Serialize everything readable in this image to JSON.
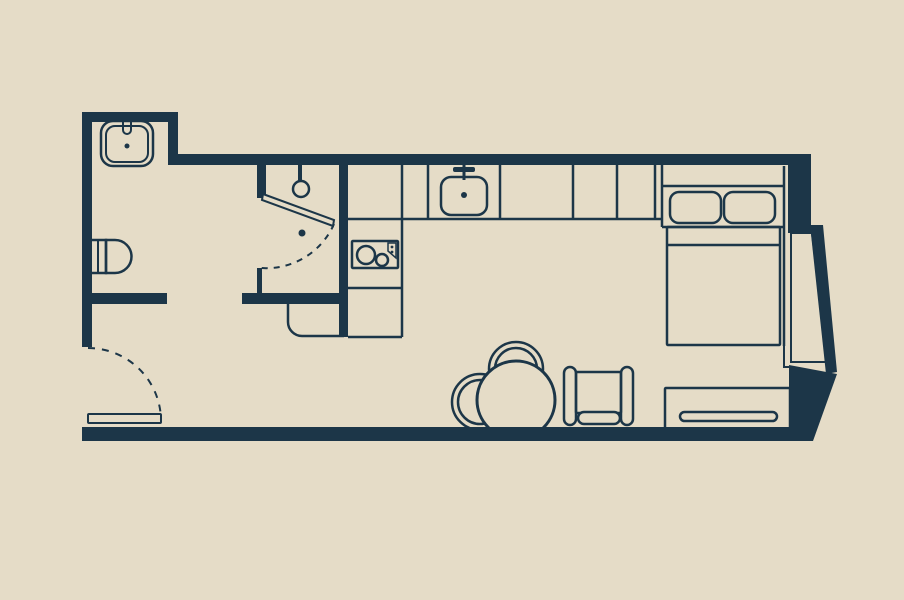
{
  "palette": {
    "background": "#e5dcc7",
    "ink": "#1c3648"
  },
  "canvas": {
    "width": 904,
    "height": 600
  },
  "floorplan": {
    "description_names": {
      "rooms": [
        "bathroom",
        "shower-room",
        "kitchen",
        "living-sleeping-area",
        "entry-hall"
      ],
      "fixtures": [
        "bathroom-sink",
        "toilet",
        "shower-head",
        "shower-door",
        "kitchen-sink",
        "cooktop",
        "kitchen-counter",
        "bed",
        "pillows",
        "window-bay",
        "dining-table",
        "dining-chairs",
        "armchair",
        "dresser",
        "entry-door"
      ]
    },
    "shapes": [
      {
        "name": "bathroom-sink-outer",
        "kind": "rect",
        "x": 101,
        "y": 121,
        "w": 52,
        "h": 45,
        "rx": 12,
        "stroke": "ink",
        "sw": 2.5,
        "fill": "none"
      },
      {
        "name": "bathroom-sink-inner",
        "kind": "rect",
        "x": 106,
        "y": 126,
        "w": 42,
        "h": 36,
        "rx": 9,
        "stroke": "ink",
        "sw": 2,
        "fill": "none"
      },
      {
        "name": "bathroom-sink-faucet",
        "kind": "path",
        "d": "M123,118 V130 A4,4 0 0 0 131,130 V118",
        "stroke": "ink",
        "sw": 2,
        "fill": "none"
      },
      {
        "name": "bathroom-sink-drain",
        "kind": "circle",
        "cx": 127,
        "cy": 146,
        "r": 2.5,
        "fill": "ink",
        "stroke": "none",
        "sw": 0
      },
      {
        "name": "toilet-tank",
        "kind": "rect",
        "x": 90,
        "y": 240,
        "w": 16,
        "h": 33,
        "rx": 0,
        "stroke": "ink",
        "sw": 2.5,
        "fill": "none"
      },
      {
        "name": "toilet-tank-line",
        "kind": "line",
        "x1": 98,
        "y1": 240,
        "x2": 98,
        "y2": 273,
        "stroke": "ink",
        "sw": 2,
        "fill": "none"
      },
      {
        "name": "toilet-bowl",
        "kind": "path",
        "d": "M106,240 H115 A16.5,16.5 0 0 1 115,273 H106 Z",
        "stroke": "ink",
        "sw": 2.5,
        "fill": "none"
      },
      {
        "name": "shower-head-stem",
        "kind": "line",
        "x1": 300,
        "y1": 165,
        "x2": 300,
        "y2": 181,
        "stroke": "ink",
        "sw": 4,
        "fill": "none"
      },
      {
        "name": "shower-head",
        "kind": "circle",
        "cx": 301,
        "cy": 189,
        "r": 8,
        "stroke": "ink",
        "sw": 2.5,
        "fill": "none"
      },
      {
        "name": "kitchen-counter-bottom-line",
        "kind": "line",
        "x1": 348,
        "y1": 219,
        "x2": 662,
        "y2": 219,
        "stroke": "ink",
        "sw": 2.5,
        "fill": "none"
      },
      {
        "name": "kitchen-counter-corner-line",
        "kind": "line",
        "x1": 402,
        "y1": 164,
        "x2": 402,
        "y2": 337,
        "stroke": "ink",
        "sw": 2.5,
        "fill": "none"
      },
      {
        "name": "kitchen-counter-column-bottom",
        "kind": "line",
        "x1": 348,
        "y1": 337,
        "x2": 402,
        "y2": 337,
        "stroke": "ink",
        "sw": 2.5,
        "fill": "none"
      },
      {
        "name": "kitchen-counter-column-divider",
        "kind": "line",
        "x1": 348,
        "y1": 288,
        "x2": 402,
        "y2": 288,
        "stroke": "ink",
        "sw": 2.5,
        "fill": "none"
      },
      {
        "name": "counter-divider-1",
        "kind": "line",
        "x1": 428,
        "y1": 164,
        "x2": 428,
        "y2": 219,
        "stroke": "ink",
        "sw": 2.5,
        "fill": "none"
      },
      {
        "name": "counter-divider-2",
        "kind": "line",
        "x1": 500,
        "y1": 164,
        "x2": 500,
        "y2": 219,
        "stroke": "ink",
        "sw": 2.5,
        "fill": "none"
      },
      {
        "name": "counter-divider-3",
        "kind": "line",
        "x1": 573,
        "y1": 164,
        "x2": 573,
        "y2": 219,
        "stroke": "ink",
        "sw": 2.5,
        "fill": "none"
      },
      {
        "name": "counter-divider-4",
        "kind": "line",
        "x1": 617,
        "y1": 164,
        "x2": 617,
        "y2": 219,
        "stroke": "ink",
        "sw": 2.5,
        "fill": "none"
      },
      {
        "name": "counter-divider-5",
        "kind": "line",
        "x1": 655,
        "y1": 164,
        "x2": 655,
        "y2": 219,
        "stroke": "ink",
        "sw": 2.5,
        "fill": "none"
      },
      {
        "name": "counter-end-panel",
        "kind": "line",
        "x1": 662,
        "y1": 164,
        "x2": 662,
        "y2": 227,
        "stroke": "ink",
        "sw": 2.5,
        "fill": "none"
      },
      {
        "name": "kitchen-sink",
        "kind": "rect",
        "x": 441,
        "y": 177,
        "w": 46,
        "h": 38,
        "rx": 10,
        "stroke": "ink",
        "sw": 2.5,
        "fill": "none"
      },
      {
        "name": "kitchen-faucet-stem",
        "kind": "line",
        "x1": 464,
        "y1": 162,
        "x2": 464,
        "y2": 180,
        "stroke": "ink",
        "sw": 3,
        "fill": "none"
      },
      {
        "name": "kitchen-faucet-bar",
        "kind": "rect",
        "x": 453,
        "y": 167,
        "w": 22,
        "h": 5,
        "rx": 2,
        "stroke": "none",
        "sw": 0,
        "fill": "ink"
      },
      {
        "name": "kitchen-sink-drain",
        "kind": "circle",
        "cx": 464,
        "cy": 195,
        "r": 3,
        "fill": "ink",
        "stroke": "none",
        "sw": 0
      },
      {
        "name": "cooktop",
        "kind": "rect",
        "x": 352,
        "y": 241,
        "w": 46,
        "h": 27,
        "rx": 1,
        "stroke": "ink",
        "sw": 2.5,
        "fill": "none"
      },
      {
        "name": "cooktop-burner-large",
        "kind": "circle",
        "cx": 366,
        "cy": 255,
        "r": 9,
        "stroke": "ink",
        "sw": 2.5,
        "fill": "none"
      },
      {
        "name": "cooktop-burner-small",
        "kind": "circle",
        "cx": 382,
        "cy": 260,
        "r": 6,
        "stroke": "ink",
        "sw": 2.5,
        "fill": "none"
      },
      {
        "name": "cooktop-control-panel",
        "kind": "path",
        "d": "M388,243 H396 V258 L388,251 Z",
        "stroke": "ink",
        "sw": 1.5,
        "fill": "none"
      },
      {
        "name": "cooktop-control-dot-1",
        "kind": "circle",
        "cx": 392,
        "cy": 247,
        "r": 1.4,
        "fill": "ink",
        "stroke": "none",
        "sw": 0
      },
      {
        "name": "cooktop-control-dot-2",
        "kind": "circle",
        "cx": 392,
        "cy": 252,
        "r": 1.4,
        "fill": "ink",
        "stroke": "none",
        "sw": 0
      },
      {
        "name": "hall-cabinet",
        "kind": "path",
        "d": "M288,304 V322 A14,14 0 0 0 302,336 H344",
        "stroke": "ink",
        "sw": 2.5,
        "fill": "none"
      },
      {
        "name": "bed-headboard-top",
        "kind": "line",
        "x1": 662,
        "y1": 186,
        "x2": 784,
        "y2": 186,
        "stroke": "ink",
        "sw": 2.5,
        "fill": "none"
      },
      {
        "name": "bed-right-edge",
        "kind": "line",
        "x1": 784,
        "y1": 166,
        "x2": 784,
        "y2": 346,
        "stroke": "ink",
        "sw": 2.5,
        "fill": "none"
      },
      {
        "name": "pillow-left",
        "kind": "rect",
        "x": 670,
        "y": 192,
        "w": 51,
        "h": 31,
        "rx": 9,
        "stroke": "ink",
        "sw": 2.5,
        "fill": "none"
      },
      {
        "name": "pillow-right",
        "kind": "rect",
        "x": 724,
        "y": 192,
        "w": 51,
        "h": 31,
        "rx": 9,
        "stroke": "ink",
        "sw": 2.5,
        "fill": "none"
      },
      {
        "name": "bed-pillow-shelf-line",
        "kind": "line",
        "x1": 662,
        "y1": 227,
        "x2": 784,
        "y2": 227,
        "stroke": "ink",
        "sw": 2.5,
        "fill": "none"
      },
      {
        "name": "bed-mattress",
        "kind": "rect",
        "x": 667,
        "y": 227,
        "w": 113,
        "h": 118,
        "rx": 1,
        "stroke": "ink",
        "sw": 2.5,
        "fill": "none"
      },
      {
        "name": "bed-blanket-fold",
        "kind": "line",
        "x1": 667,
        "y1": 245,
        "x2": 780,
        "y2": 245,
        "stroke": "ink",
        "sw": 2.5,
        "fill": "none"
      },
      {
        "name": "bed-foot-step",
        "kind": "path",
        "d": "M784,346 V367 H791",
        "stroke": "ink",
        "sw": 2,
        "fill": "none"
      },
      {
        "name": "window-bay-glass",
        "kind": "polygon",
        "points": "791,233 812,233 827,362 791,362",
        "stroke": "ink",
        "sw": 2,
        "fill": "none"
      },
      {
        "name": "dining-chair-top-outer",
        "kind": "circle",
        "cx": 516,
        "cy": 369,
        "r": 27,
        "stroke": "ink",
        "sw": 2.5,
        "fill": "none"
      },
      {
        "name": "dining-chair-top-inner",
        "kind": "circle",
        "cx": 516,
        "cy": 369,
        "r": 21,
        "stroke": "ink",
        "sw": 2.5,
        "fill": "none"
      },
      {
        "name": "dining-chair-left-outer",
        "kind": "circle",
        "cx": 480,
        "cy": 402,
        "r": 28,
        "stroke": "ink",
        "sw": 2.5,
        "fill": "none"
      },
      {
        "name": "dining-chair-left-inner",
        "kind": "circle",
        "cx": 480,
        "cy": 402,
        "r": 22,
        "stroke": "ink",
        "sw": 2.5,
        "fill": "none"
      },
      {
        "name": "dining-table",
        "kind": "circle",
        "cx": 516,
        "cy": 400,
        "r": 39,
        "stroke": "ink",
        "sw": 3,
        "fill": "bg"
      },
      {
        "name": "armchair-left-armrest",
        "kind": "rect",
        "x": 564,
        "y": 367,
        "w": 12,
        "h": 58,
        "rx": 6,
        "stroke": "ink",
        "sw": 2.5,
        "fill": "none"
      },
      {
        "name": "armchair-right-armrest",
        "kind": "rect",
        "x": 621,
        "y": 367,
        "w": 12,
        "h": 58,
        "rx": 6,
        "stroke": "ink",
        "sw": 2.5,
        "fill": "none"
      },
      {
        "name": "armchair-seat",
        "kind": "rect",
        "x": 576,
        "y": 372,
        "w": 45,
        "h": 41,
        "rx": 1,
        "stroke": "ink",
        "sw": 2.5,
        "fill": "none"
      },
      {
        "name": "armchair-front-cushion",
        "kind": "rect",
        "x": 578,
        "y": 412,
        "w": 42,
        "h": 12,
        "rx": 6,
        "stroke": "ink",
        "sw": 2.5,
        "fill": "bg"
      },
      {
        "name": "dresser",
        "kind": "rect",
        "x": 665,
        "y": 388,
        "w": 125,
        "h": 41,
        "rx": 1,
        "stroke": "ink",
        "sw": 2.5,
        "fill": "none"
      },
      {
        "name": "dresser-handle",
        "kind": "rect",
        "x": 680,
        "y": 412,
        "w": 97,
        "h": 9,
        "rx": 4.5,
        "stroke": "ink",
        "sw": 2.5,
        "fill": "none"
      },
      {
        "name": "wall-bathroom-top",
        "kind": "rect",
        "x": 82,
        "y": 112,
        "w": 96,
        "h": 10,
        "rx": 0,
        "fill": "ink",
        "stroke": "none",
        "sw": 0
      },
      {
        "name": "wall-top-jog",
        "kind": "rect",
        "x": 168,
        "y": 112,
        "w": 10,
        "h": 53,
        "rx": 0,
        "fill": "ink",
        "stroke": "none",
        "sw": 0
      },
      {
        "name": "wall-top-main",
        "kind": "rect",
        "x": 168,
        "y": 154,
        "w": 643,
        "h": 11,
        "rx": 0,
        "fill": "ink",
        "stroke": "none",
        "sw": 0
      },
      {
        "name": "wall-left",
        "kind": "rect",
        "x": 82,
        "y": 112,
        "w": 10,
        "h": 235,
        "rx": 0,
        "fill": "ink",
        "stroke": "none",
        "sw": 0
      },
      {
        "name": "wall-bottom",
        "kind": "rect",
        "x": 82,
        "y": 427,
        "w": 730,
        "h": 14,
        "rx": 0,
        "fill": "ink",
        "stroke": "none",
        "sw": 0
      },
      {
        "name": "wall-shower-kitchen",
        "kind": "rect",
        "x": 339,
        "y": 164,
        "w": 9,
        "h": 173,
        "rx": 0,
        "fill": "ink",
        "stroke": "none",
        "sw": 0
      },
      {
        "name": "wall-bathroom-shower",
        "kind": "rect",
        "x": 257,
        "y": 164,
        "w": 9,
        "h": 34,
        "rx": 0,
        "fill": "ink",
        "stroke": "none",
        "sw": 0
      },
      {
        "name": "wall-hall-stub-west",
        "kind": "rect",
        "x": 85,
        "y": 293,
        "w": 82,
        "h": 11,
        "rx": 0,
        "fill": "ink",
        "stroke": "none",
        "sw": 0
      },
      {
        "name": "wall-hall-stub-east",
        "kind": "rect",
        "x": 242,
        "y": 293,
        "w": 97,
        "h": 11,
        "rx": 0,
        "fill": "ink",
        "stroke": "none",
        "sw": 0
      },
      {
        "name": "wall-shower-stub",
        "kind": "rect",
        "x": 257,
        "y": 268,
        "w": 5,
        "h": 27,
        "rx": 0,
        "fill": "ink",
        "stroke": "none",
        "sw": 0
      },
      {
        "name": "wall-right-top-corner",
        "kind": "rect",
        "x": 788,
        "y": 154,
        "w": 23,
        "h": 79,
        "rx": 0,
        "fill": "ink",
        "stroke": "none",
        "sw": 0
      },
      {
        "name": "wall-window-slant",
        "kind": "polygon",
        "points": "810,225 823,225 837,372 826,374",
        "fill": "ink",
        "stroke": "none",
        "sw": 0
      },
      {
        "name": "wall-right-bottom-corner",
        "kind": "polygon",
        "points": "789,365 837,374 813,441 789,441",
        "fill": "ink",
        "stroke": "none",
        "sw": 0
      },
      {
        "name": "shower-door-leaf",
        "kind": "polygon",
        "points": "263,194 334,220 333,226 262,200",
        "stroke": "ink",
        "sw": 2,
        "fill": "bg"
      },
      {
        "name": "shower-door-swing-arc",
        "kind": "path",
        "d": "M334,224 A74,74 0 0 1 261,268",
        "stroke": "ink",
        "sw": 2,
        "fill": "none",
        "dash": "6,6"
      },
      {
        "name": "shower-door-handle",
        "kind": "circle",
        "cx": 302,
        "cy": 233,
        "r": 3.5,
        "fill": "ink",
        "stroke": "none",
        "sw": 0
      },
      {
        "name": "entry-door-leaf",
        "kind": "rect",
        "x": 88,
        "y": 414,
        "w": 73,
        "h": 9,
        "rx": 1,
        "stroke": "ink",
        "sw": 2,
        "fill": "bg"
      },
      {
        "name": "entry-door-swing-arc",
        "kind": "path",
        "d": "M88,348 A73,73 0 0 1 161,421",
        "stroke": "ink",
        "sw": 2,
        "fill": "none",
        "dash": "7,7"
      }
    ]
  }
}
